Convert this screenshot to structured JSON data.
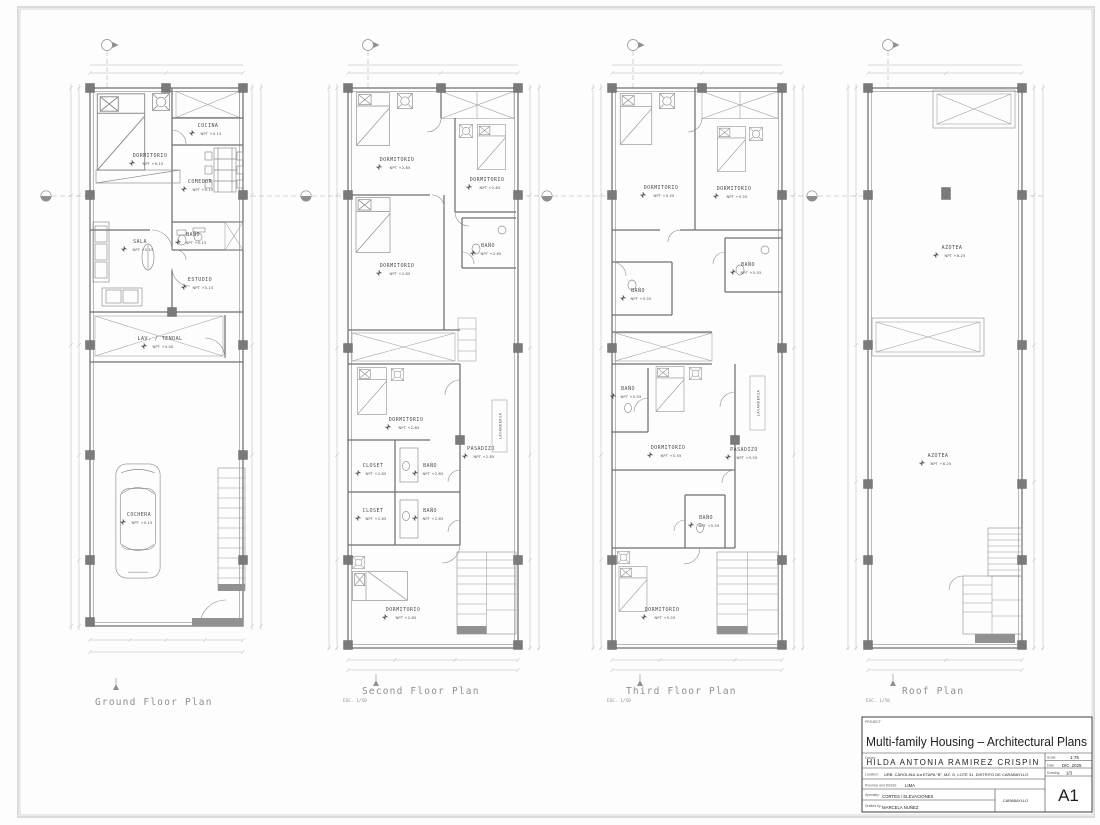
{
  "sheet": {
    "format": "A1"
  },
  "plans": [
    {
      "title": "Ground Floor Plan",
      "scale": "",
      "rooms": [
        {
          "name": "DORMITORIO",
          "level": "NPT +0.15"
        },
        {
          "name": "COCINA",
          "level": "NPT +0.15"
        },
        {
          "name": "COMEDOR",
          "level": "NPT +0.15"
        },
        {
          "name": "SALA",
          "level": "NPT +0.15"
        },
        {
          "name": "BAÑO",
          "level": "NPT +0.15"
        },
        {
          "name": "ESTUDIO",
          "level": "NPT +0.15"
        },
        {
          "name": "LAV. / TENDAL",
          "level": "NPT +0.00"
        },
        {
          "name": "COCHERA",
          "level": "NPT +0.15"
        }
      ]
    },
    {
      "title": "Second Floor Plan",
      "scale": "ESC. 1/50",
      "rooms": [
        {
          "name": "DORMITORIO",
          "level": "NPT +2.85"
        },
        {
          "name": "DORMITORIO",
          "level": "NPT +2.85"
        },
        {
          "name": "DORMITORIO",
          "level": "NPT +2.85"
        },
        {
          "name": "BAÑO",
          "level": "NPT +2.85"
        },
        {
          "name": "DORMITORIO",
          "level": "NPT +2.85"
        },
        {
          "name": "CLOSET",
          "level": "NPT +2.85"
        },
        {
          "name": "BAÑO",
          "level": "NPT +2.85"
        },
        {
          "name": "CLOSET",
          "level": "NPT +2.85"
        },
        {
          "name": "BAÑO",
          "level": "NPT +2.85"
        },
        {
          "name": "PASADIZO",
          "level": "NPT +2.85"
        },
        {
          "name": "LAVANDERIA"
        },
        {
          "name": "DORMITORIO",
          "level": "NPT +2.85"
        }
      ]
    },
    {
      "title": "Third Floor Plan",
      "scale": "ESC. 1/50",
      "rooms": [
        {
          "name": "DORMITORIO",
          "level": "NPT +5.55"
        },
        {
          "name": "DORMITORIO",
          "level": "NPT +5.55"
        },
        {
          "name": "BAÑO",
          "level": "NPT +5.55"
        },
        {
          "name": "BAÑO",
          "level": "NPT +5.55"
        },
        {
          "name": "DORMITORIO",
          "level": "NPT +5.55"
        },
        {
          "name": "BAÑO",
          "level": "NPT +5.55"
        },
        {
          "name": "PASADIZO",
          "level": "NPT +5.55"
        },
        {
          "name": "BAÑO",
          "level": "NPT +5.55"
        },
        {
          "name": "LAVANDERIA"
        },
        {
          "name": "DORMITORIO",
          "level": "NPT +5.55"
        }
      ]
    },
    {
      "title": "Roof Plan",
      "scale": "ESC. 1/50",
      "rooms": [
        {
          "name": "AZOTEA",
          "level": "NPT +8.25"
        },
        {
          "name": "AZOTEA",
          "level": "NPT +8.25"
        }
      ]
    }
  ],
  "title_block": {
    "project_label": "PROJECT",
    "project_title": "Multi-family Housing – Architectural Plans",
    "owner_label": "Owner:",
    "owner": "HILDA ANTONIA RAMIREZ CRISPIN",
    "location_label": "Location:",
    "location": "URB. CAROLINA 1ra ETAPA \"B\", MZ. G, LOTE 31, DISTRITO DE CARABAYLLO",
    "province_label": "Province and District:",
    "province": "LIMA",
    "specialty_label": "Specialty:",
    "specialty": "CORTES / ELEVACIONES",
    "drafted_label": "Drafted by:",
    "drafted_by": "MARCELA NUÑEZ",
    "stamp": "CARABAYLLO",
    "scale_label": "Scale",
    "scale_value": "1:75",
    "date_label": "Date",
    "date_value": "DIC. 2025",
    "drawing_label": "Drawing",
    "drawing_value": "1/3",
    "sheet_number": "A1"
  }
}
